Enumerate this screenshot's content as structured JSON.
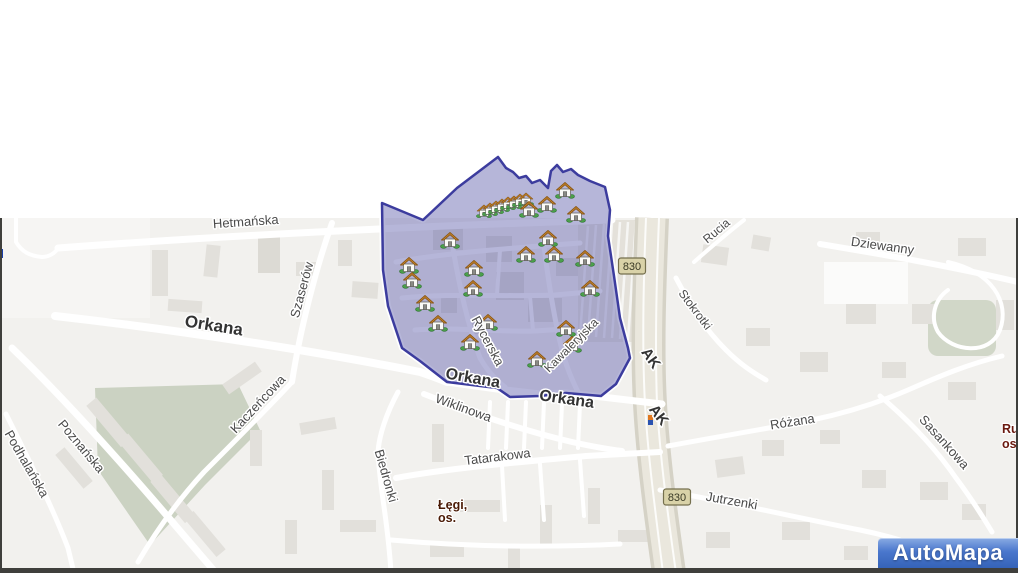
{
  "map": {
    "background": "#f2f1ee",
    "frame_border_color": "#3f3f3c",
    "district_polygon": {
      "name": "highlighted-district",
      "fill": "rgba(115,115,182,0.52)",
      "border": "#3c3c9e",
      "points": "382,203 423,220 457,188 498,157 506,168 513,172 519,178 526,176 532,183 540,180 548,188 551,171 557,165 563,172 571,169 578,175 590,181 605,187 610,210 608,236 614,276 620,318 628,348 630,358 616,384 601,396 566,393 540,396 510,397 497,388 447,382 420,361 402,348 396,330 388,306 383,270"
    },
    "street_labels": [
      {
        "text": "Hetmańska",
        "x": 246,
        "y": 226,
        "rot": -4,
        "size": 13,
        "bold": false
      },
      {
        "text": "Szaserów",
        "x": 306,
        "y": 291,
        "rot": -75,
        "size": 13,
        "bold": false
      },
      {
        "text": "Orkana",
        "x": 213,
        "y": 331,
        "rot": 9,
        "size": 17,
        "bold": true
      },
      {
        "text": "Orkana",
        "x": 472,
        "y": 383,
        "rot": 10,
        "size": 16,
        "bold": true
      },
      {
        "text": "Orkana",
        "x": 566,
        "y": 404,
        "rot": 8,
        "size": 16,
        "bold": true
      },
      {
        "text": "Rycerska",
        "x": 484,
        "y": 343,
        "rot": 62,
        "size": 13,
        "bold": false
      },
      {
        "text": "Kawaleryjska",
        "x": 574,
        "y": 348,
        "rot": -45,
        "size": 12,
        "bold": false
      },
      {
        "text": "AK",
        "x": 647,
        "y": 361,
        "rot": 55,
        "size": 15,
        "bold": true,
        "color": "#222222"
      },
      {
        "text": "AK",
        "x": 655,
        "y": 418,
        "rot": 52,
        "size": 15,
        "bold": true,
        "color": "#222222"
      },
      {
        "text": "Stokrotki",
        "x": 692,
        "y": 312,
        "rot": 53,
        "size": 12,
        "bold": false
      },
      {
        "text": "Rucia",
        "x": 719,
        "y": 234,
        "rot": -40,
        "size": 12,
        "bold": false
      },
      {
        "text": "Dziewanny",
        "x": 882,
        "y": 250,
        "rot": 8,
        "size": 13,
        "bold": false
      },
      {
        "text": "Różana",
        "x": 793,
        "y": 426,
        "rot": -9,
        "size": 13,
        "bold": false
      },
      {
        "text": "Jutrzenki",
        "x": 731,
        "y": 505,
        "rot": 10,
        "size": 13,
        "bold": false
      },
      {
        "text": "Sasankowa",
        "x": 941,
        "y": 445,
        "rot": 48,
        "size": 13,
        "bold": false
      },
      {
        "text": "Wiklinowa",
        "x": 462,
        "y": 412,
        "rot": 20,
        "size": 13,
        "bold": false
      },
      {
        "text": "Tatarakowa",
        "x": 498,
        "y": 461,
        "rot": -7,
        "size": 13,
        "bold": false
      },
      {
        "text": "Biedronki",
        "x": 382,
        "y": 477,
        "rot": 74,
        "size": 13,
        "bold": false
      },
      {
        "text": "Kaczeńcowa",
        "x": 261,
        "y": 407,
        "rot": -47,
        "size": 13,
        "bold": false
      },
      {
        "text": "Poznańska",
        "x": 78,
        "y": 449,
        "rot": 50,
        "size": 13,
        "bold": false
      },
      {
        "text": "Podhalańska",
        "x": 23,
        "y": 466,
        "rot": 60,
        "size": 13,
        "bold": false
      }
    ],
    "district_labels": [
      {
        "lines": [
          "Łęgi,",
          "os."
        ],
        "x": 438,
        "y": 509,
        "line_height": 13,
        "color": "#4a1a05"
      },
      {
        "lines": [
          "Ru",
          "os"
        ],
        "x": 1002,
        "y": 433,
        "line_height": 15,
        "color": "#6b1a10"
      }
    ],
    "route_badges": [
      {
        "text": "830",
        "x": 632,
        "y": 266
      },
      {
        "text": "830",
        "x": 677,
        "y": 497
      }
    ],
    "badge_style": {
      "fill": "#d9d2a8",
      "border": "#75704e"
    },
    "houses": {
      "single": [
        [
          565,
          190
        ],
        [
          547,
          204
        ],
        [
          529,
          209
        ],
        [
          576,
          214
        ],
        [
          450,
          240
        ],
        [
          548,
          238
        ],
        [
          526,
          254
        ],
        [
          554,
          254
        ],
        [
          585,
          258
        ],
        [
          409,
          265
        ],
        [
          474,
          268
        ],
        [
          412,
          280
        ],
        [
          473,
          288
        ],
        [
          590,
          288
        ],
        [
          425,
          303
        ],
        [
          438,
          323
        ],
        [
          488,
          322
        ],
        [
          470,
          342
        ],
        [
          566,
          328
        ],
        [
          572,
          344
        ],
        [
          537,
          359
        ]
      ],
      "cluster": [
        [
          484,
          211
        ],
        [
          490,
          209
        ],
        [
          496,
          207
        ],
        [
          502,
          205
        ],
        [
          508,
          203
        ],
        [
          514,
          202
        ],
        [
          520,
          200
        ],
        [
          526,
          199
        ]
      ]
    },
    "logo": {
      "text": "AutoMapa"
    }
  }
}
